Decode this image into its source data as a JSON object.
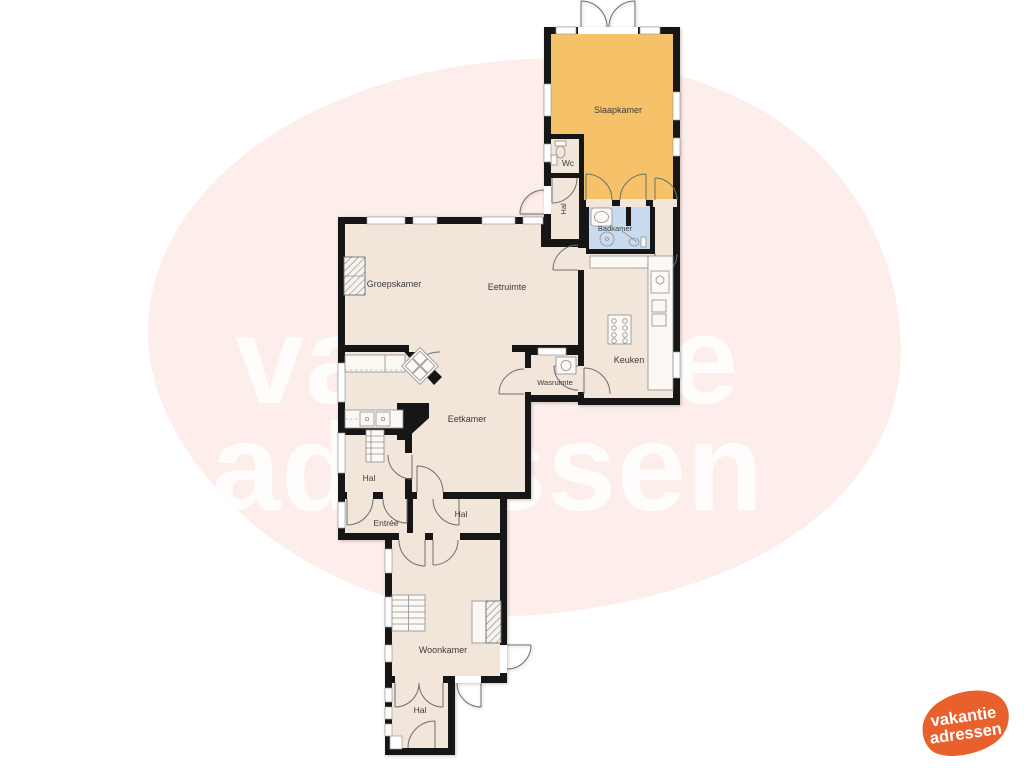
{
  "watermark": {
    "line1": "vakantie",
    "line2": "adressen"
  },
  "logo": {
    "line1": "vakantie",
    "line2": "adressen"
  },
  "palette": {
    "page_bg": "#ffffff",
    "blob": "#fdedeb",
    "floor": "#f2e5d9",
    "bedroom": "#f6c269",
    "bathroom": "#c9dcef",
    "wall": "#161616",
    "label": "#3b3b3b",
    "watermark_color": "rgba(255,255,255,0.85)",
    "logo_orange": "#e8612d",
    "logo_text": "#ffffff"
  },
  "rooms": [
    {
      "id": "slaapkamer",
      "label": "Slaapkamer"
    },
    {
      "id": "wc",
      "label": "Wc"
    },
    {
      "id": "hal-boven",
      "label": "Hal"
    },
    {
      "id": "badkamer",
      "label": "Badkamer"
    },
    {
      "id": "keuken",
      "label": "Keuken"
    },
    {
      "id": "groepskamer",
      "label": "Groepskamer"
    },
    {
      "id": "eetruimte",
      "label": "Eetruimte"
    },
    {
      "id": "wasruimte",
      "label": "Wasruimte"
    },
    {
      "id": "eetkamer",
      "label": "Eetkamer"
    },
    {
      "id": "hal-tussen",
      "label": "Hal"
    },
    {
      "id": "entree",
      "label": "Entrée"
    },
    {
      "id": "hal-midden",
      "label": "Hal"
    },
    {
      "id": "woonkamer",
      "label": "Woonkamer"
    },
    {
      "id": "hal-beneden",
      "label": "Hal"
    }
  ]
}
